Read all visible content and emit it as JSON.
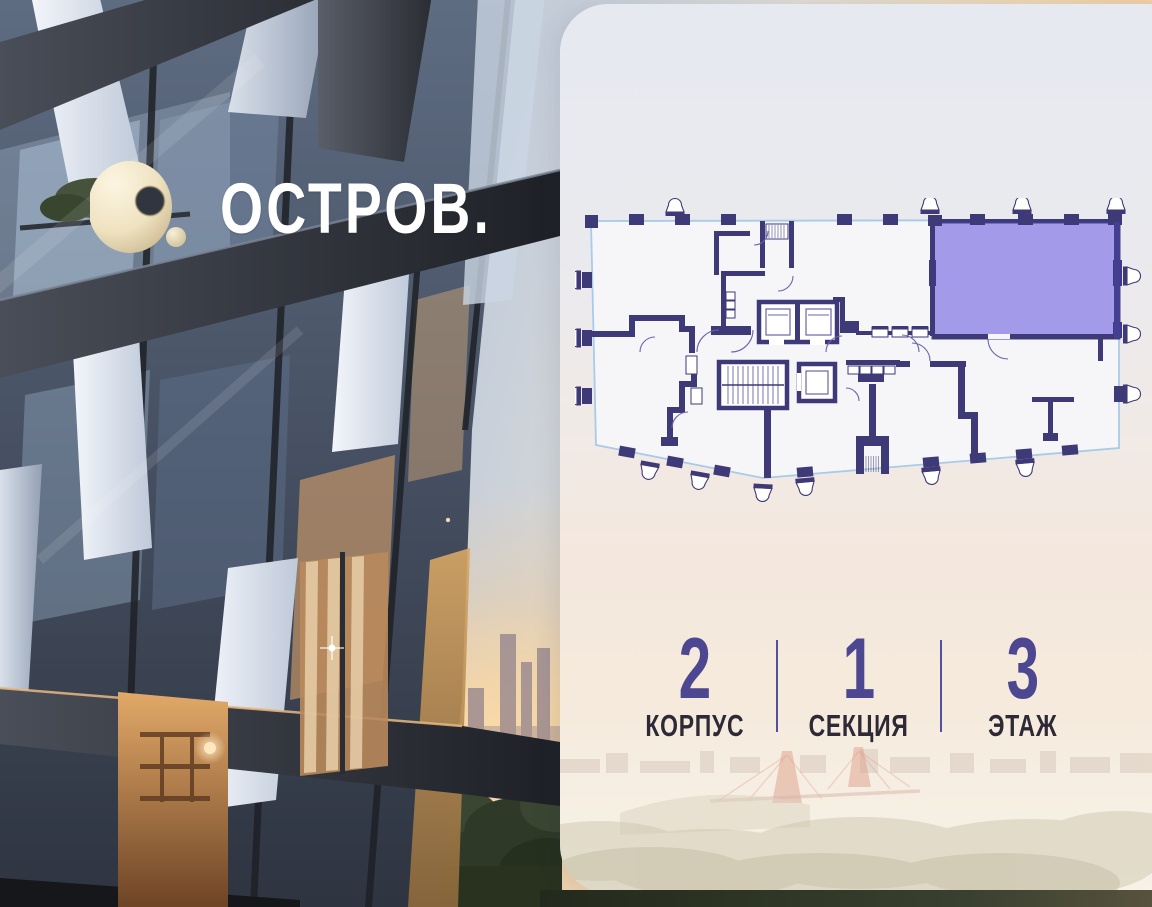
{
  "brand": {
    "wordmark": "ОСТРОВ.",
    "logo_mark": "torus-icon",
    "mark_color": "#EFE2C0"
  },
  "floorplan": {
    "wall_color": "#3E3977",
    "glazing_color": "#A7CBE9",
    "highlighted_unit": {
      "fill": "#978EE7",
      "stroke": "#453F90",
      "selected": true
    }
  },
  "meta": {
    "items": [
      {
        "value": "2",
        "label": "КОРПУС"
      },
      {
        "value": "1",
        "label": "СЕКЦИЯ"
      },
      {
        "value": "3",
        "label": "ЭТАЖ"
      }
    ],
    "value_color": "#4C4790",
    "label_color": "#2D2936",
    "divider_color": "#55509B"
  },
  "scenery": {
    "bridge_color": "#D2745B",
    "card_top_color": "#E6E9F0",
    "card_bottom_color": "#F7F1E6"
  }
}
